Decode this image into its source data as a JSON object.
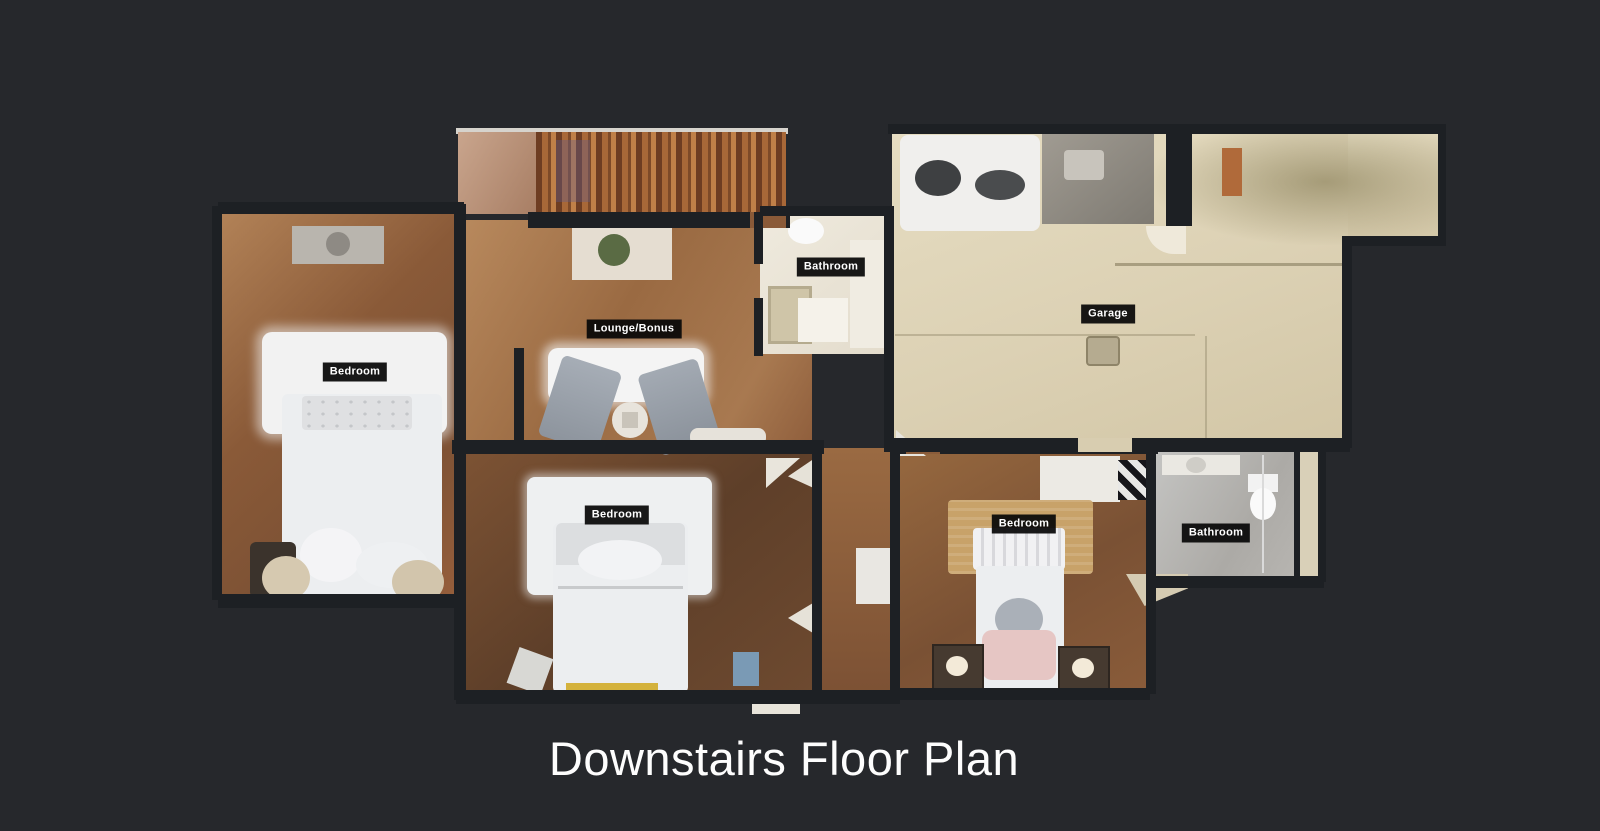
{
  "page": {
    "title": "Downstairs Floor Plan",
    "title_color": "#fdfdfd",
    "background_color": "#26282c"
  },
  "floor_plan": {
    "label_bg": "#080808",
    "label_text_color": "#ffffff",
    "rooms": [
      {
        "id": "bedroom-left",
        "label": "Bedroom"
      },
      {
        "id": "lounge-bonus",
        "label": "Lounge/Bonus"
      },
      {
        "id": "bathroom-upper",
        "label": "Bathroom"
      },
      {
        "id": "garage",
        "label": "Garage"
      },
      {
        "id": "bedroom-middle",
        "label": "Bedroom"
      },
      {
        "id": "bedroom-right",
        "label": "Bedroom"
      },
      {
        "id": "bathroom-lower",
        "label": "Bathroom"
      }
    ],
    "colors": {
      "wall": "#1d2024",
      "wood_light": "#b28257",
      "wood_medium": "#8a5c3a",
      "wood_dark": "#6e4a30",
      "garage_floor": "#ddd2b6",
      "bathroom_floor": "#ece7db",
      "tile_gray": "#b5b2ae",
      "bed_white": "#eceef0",
      "rug_tan": "#c8a269",
      "chair_gray": "#9aa2ac"
    }
  }
}
